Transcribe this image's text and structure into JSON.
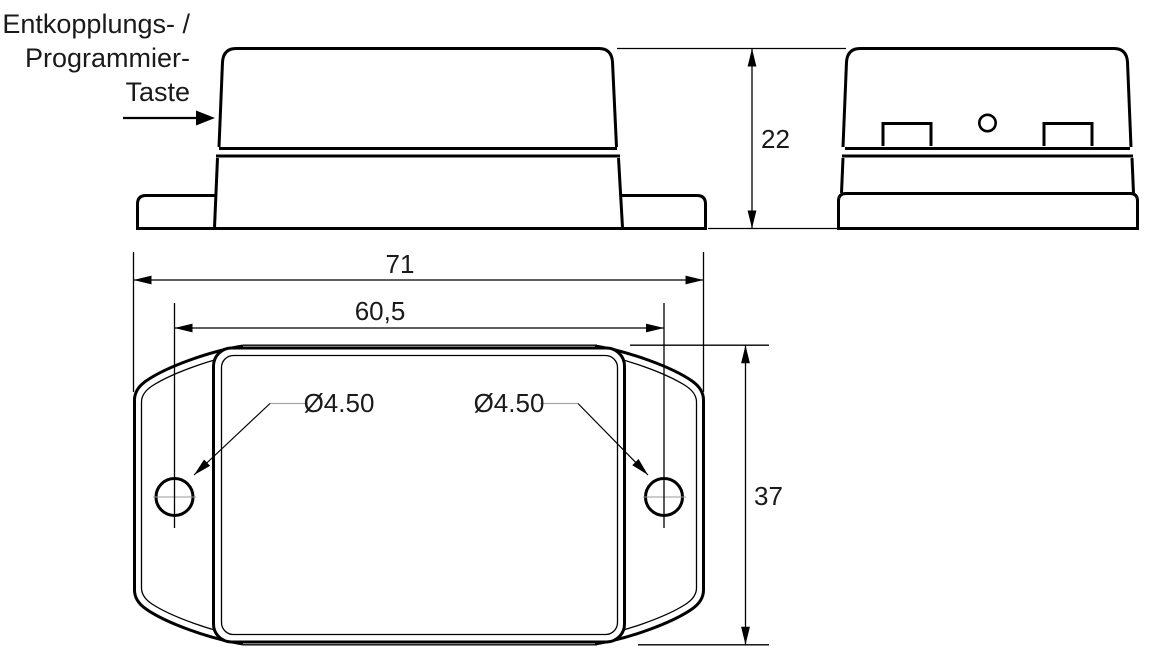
{
  "annotation": {
    "line1": "Entkopplungs- /",
    "line2": "Programmier-",
    "line3": "Taste"
  },
  "dimensions": {
    "overall_width": "71",
    "hole_spacing": "60,5",
    "body_depth": "37",
    "height": "22",
    "hole_diameter_left": "Ø4.50",
    "hole_diameter_right": "Ø4.50"
  },
  "colors": {
    "line": "#000000",
    "leader_gray": "#a8a8a8",
    "background": "#ffffff"
  }
}
